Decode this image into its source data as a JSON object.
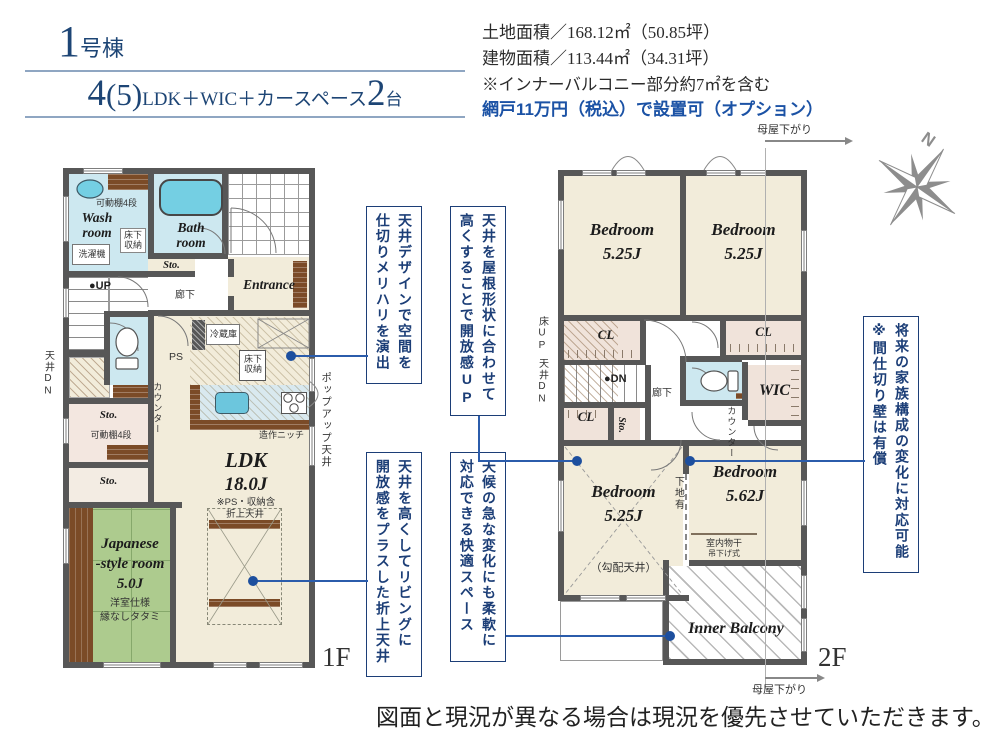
{
  "header": {
    "unit_no": "1",
    "unit_suffix": "号棟",
    "plan_num": "4",
    "plan_paren": "(5)",
    "plan_rooms": "LDK＋WIC＋カースペース",
    "plan_cars": "2",
    "plan_cars_suffix": "台"
  },
  "info": {
    "land": "土地面積／168.12㎡（50.85坪）",
    "building": "建物面積／113.44㎡（34.31坪）",
    "note": "※インナーバルコニー部分約7㎡を含む",
    "screen": "網戸11万円（税込）で設置可（オプション）"
  },
  "f1": {
    "floor": "1F",
    "shelf_top": "可動棚4段",
    "wash": "Wash room",
    "underfloor1": "床下収納",
    "washer": "洗濯機",
    "bath": "Bath room",
    "sto1": "Sto.",
    "entrance": "Entrance",
    "hall": "廊下",
    "up": "●UP",
    "ps": "PS",
    "fridge": "冷蔵庫",
    "underfloor2": "床下収納",
    "counter": "カウンター",
    "ceiling_dn": "天井DN",
    "sto2": "Sto.",
    "shelf_mid": "可動棚4段",
    "sto3": "Sto.",
    "ldk": "LDK",
    "ldk_size": "18.0J",
    "ldk_note": "※PS・収納含",
    "coffered": "折上天井",
    "niche": "造作ニッチ",
    "popup": "ポップアップ天井",
    "jp1": "Japanese",
    "jp2": "-style room",
    "jp_size": "5.0J",
    "jp_note1": "洋室仕様",
    "jp_note2": "縁なしタタミ"
  },
  "f2": {
    "floor": "2F",
    "moya_top": "母屋下がり",
    "moya_btm": "母屋下がり",
    "bed1": "Bedroom",
    "bed1_size": "5.25J",
    "bed2": "Bedroom",
    "bed2_size": "5.25J",
    "bed3": "Bedroom",
    "bed3_size": "5.25J",
    "bed4": "Bedroom",
    "bed4_size": "5.62J",
    "cl1": "CL",
    "cl2": "CL",
    "cl3": "CL",
    "floor_up": "床UP",
    "ceiling_dn": "天井DN",
    "dn": "●DN",
    "hall": "廊下",
    "sto": "Sto.",
    "wic": "WIC",
    "counter": "カウンター",
    "slope": "（勾配天井）",
    "backing": "下地有",
    "drying": "室内物干",
    "hanging": "吊下げ式",
    "balcony": "Inner Balcony",
    "north": "N"
  },
  "annotations": {
    "a1": "天井デザインで空間を\n仕切りメリハリを演出",
    "a2": "天井を屋根形状に合わせて\n高くすることで開放感UP",
    "a3": "天井を高くしてリビングに\n開放感をプラスした折上天井",
    "a4": "天候の急な変化にも柔軟に\n対応できる快適スペース",
    "a5": "将来の家族構成の変化に対応可能\n※間仕切り壁は有償"
  },
  "disclaimer": "図面と現況が異なる場合は現況を優先させていただきます。",
  "colors": {
    "accent_blue": "#1c3e77",
    "title_blue": "#1d4575",
    "screen_note_blue": "#1b52a5",
    "wall_gray": "#575757",
    "floor_beige": "#f2ecda",
    "closet_pink": "#f0e3da",
    "water_blue": "#cde8f0",
    "tub_blue": "#74cfe3",
    "tatami_green": "#adcb8e",
    "wood_brown": "#7b4b27",
    "leader_blue": "#2b5cab"
  }
}
